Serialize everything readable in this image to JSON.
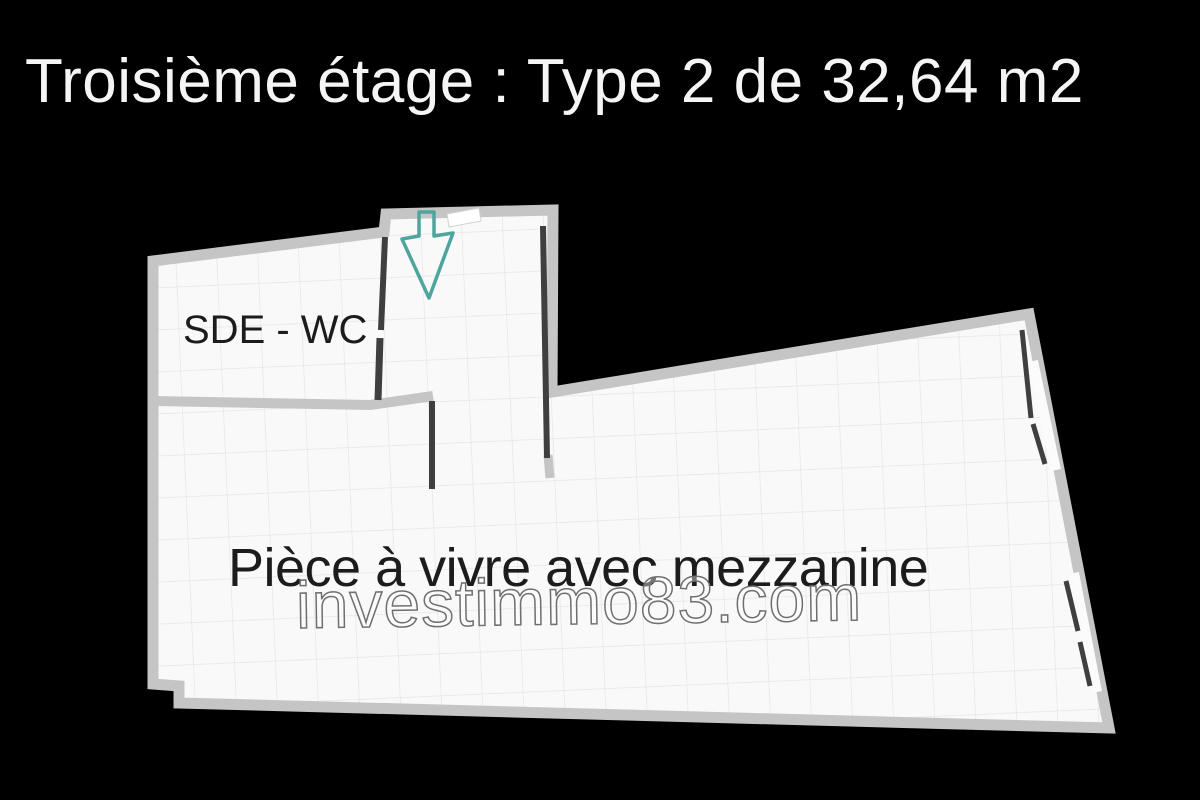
{
  "title": "Troisième étage : Type 2 de 32,64 m2",
  "floorplan": {
    "rooms": [
      {
        "label": "SDE - WC"
      },
      {
        "label": "Pièce à vivre avec mezzanine"
      }
    ],
    "watermark": "investimmo83.com",
    "entrance_arrow": "down-arrow"
  },
  "colors": {
    "background": "#000000",
    "floor": "#faf9f9",
    "grid": "#e7e4e4",
    "wall": "#c6c5c5",
    "wall_dark": "#3f3f3f",
    "window_white": "#fbfbfb",
    "arrow": "#4ea59d",
    "title_text": "#f5f5f5",
    "room_text": "#1c1c1c",
    "watermark_outline": "#6f6f6f"
  }
}
